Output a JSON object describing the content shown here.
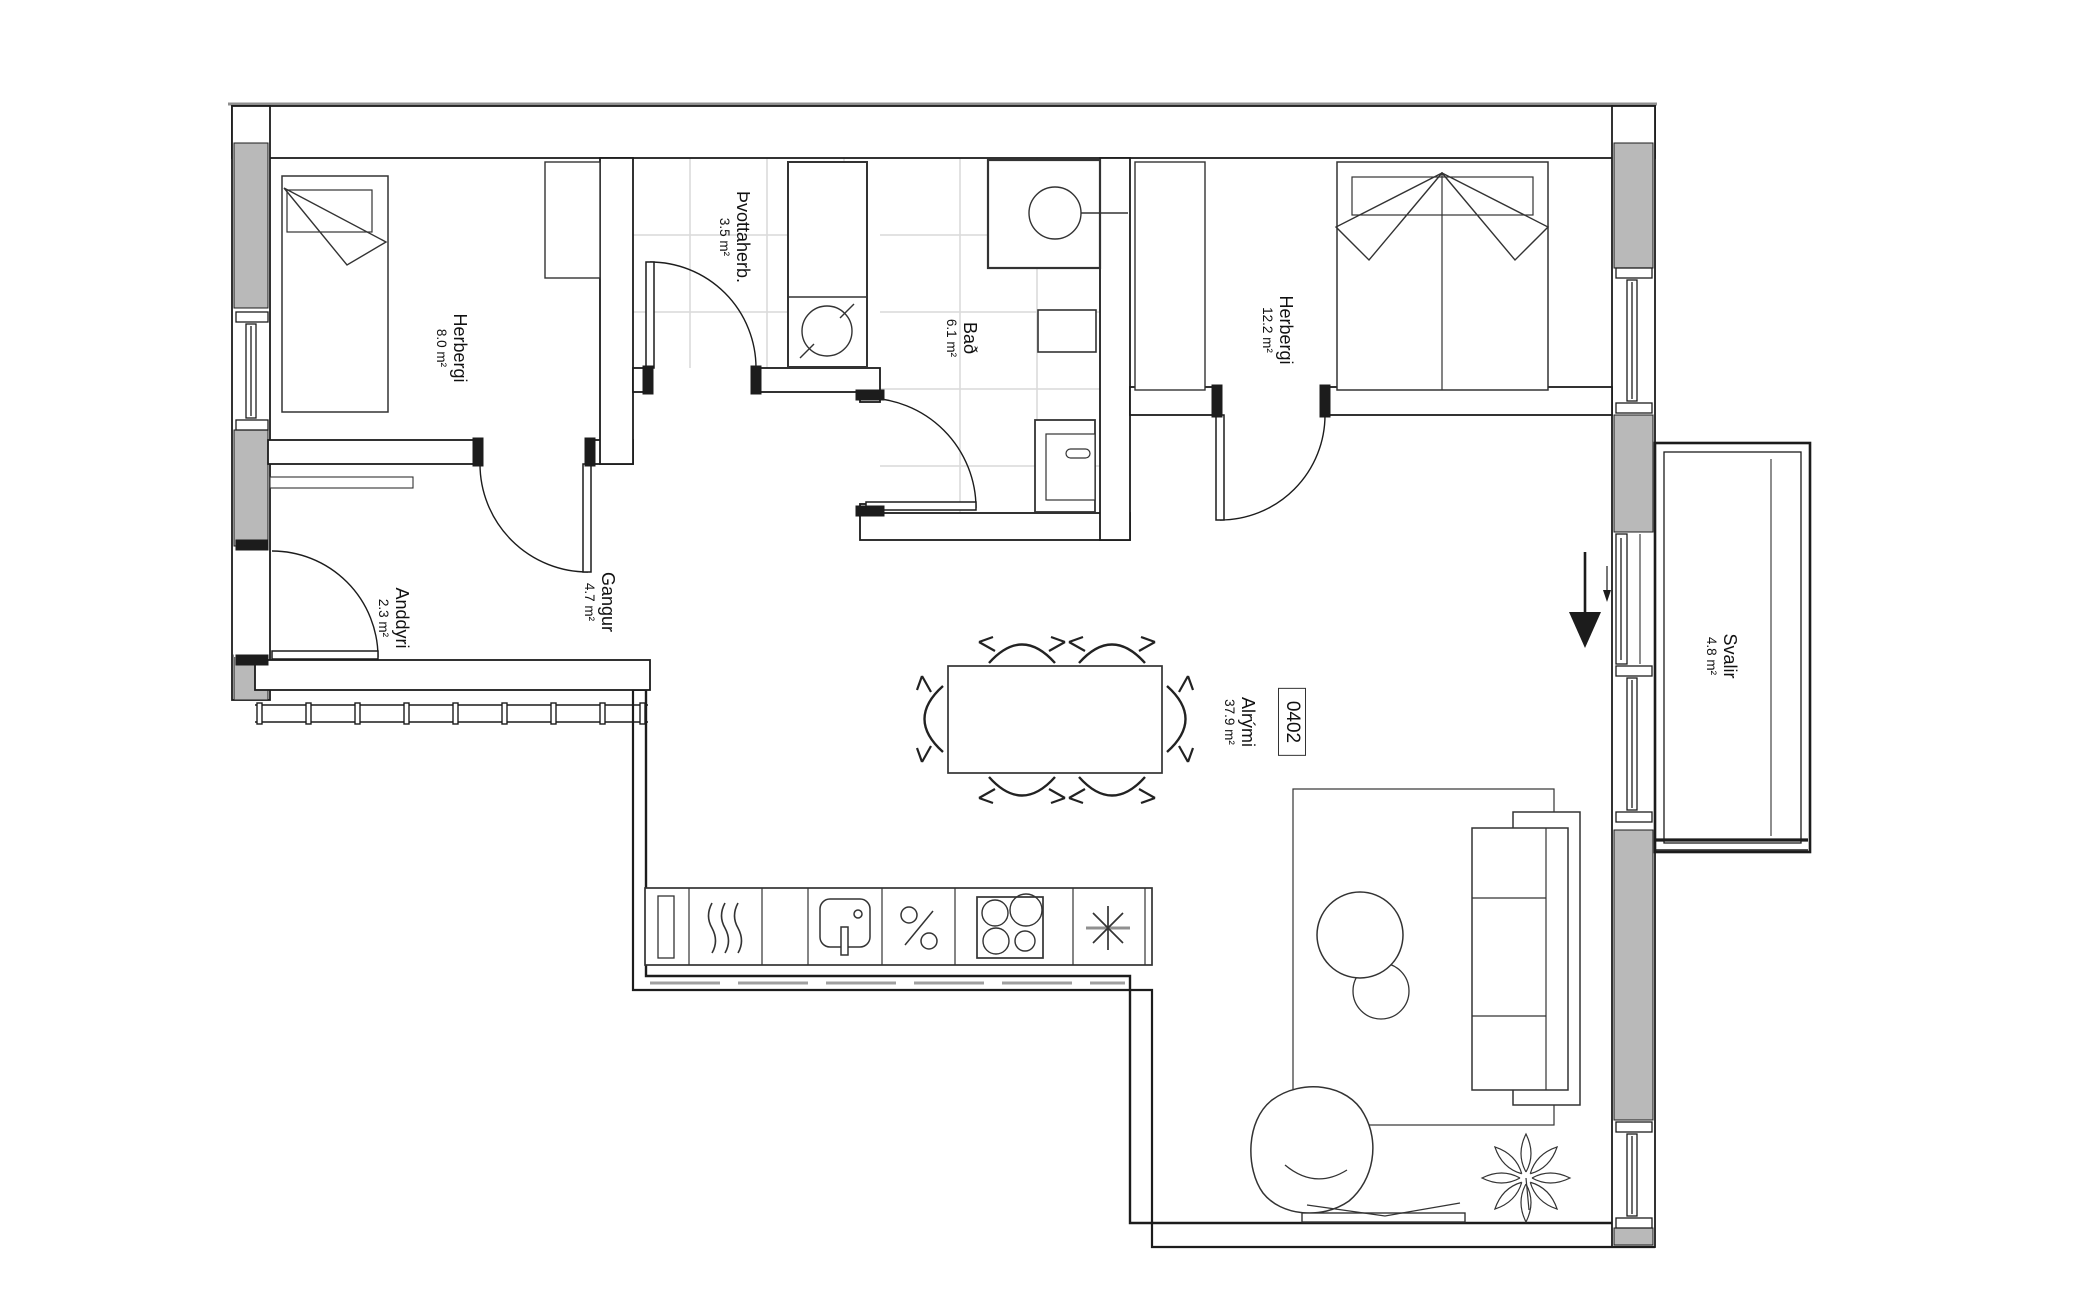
{
  "floor_plan": {
    "unit_number": "0402",
    "rooms": [
      {
        "id": "bedroom-1",
        "name": "Herbergi",
        "area": "8.0 m²"
      },
      {
        "id": "laundry",
        "name": "Þvottaherb.",
        "area": "3.5 m²"
      },
      {
        "id": "bathroom",
        "name": "Bað",
        "area": "6.1 m²"
      },
      {
        "id": "bedroom-2",
        "name": "Herbergi",
        "area": "12.2 m²"
      },
      {
        "id": "entrance",
        "name": "Anddyri",
        "area": "2.3 m²"
      },
      {
        "id": "hallway",
        "name": "Gangur",
        "area": "4.7 m²"
      },
      {
        "id": "living",
        "name": "Alrými",
        "area": "37.9 m²"
      },
      {
        "id": "balcony",
        "name": "Svalir",
        "area": "4.8 m²"
      }
    ],
    "colors": {
      "wall_fill": "#b9b9b9",
      "line": "#1c1c1c",
      "tile": "#d9d9d9",
      "background": "#ffffff"
    }
  }
}
